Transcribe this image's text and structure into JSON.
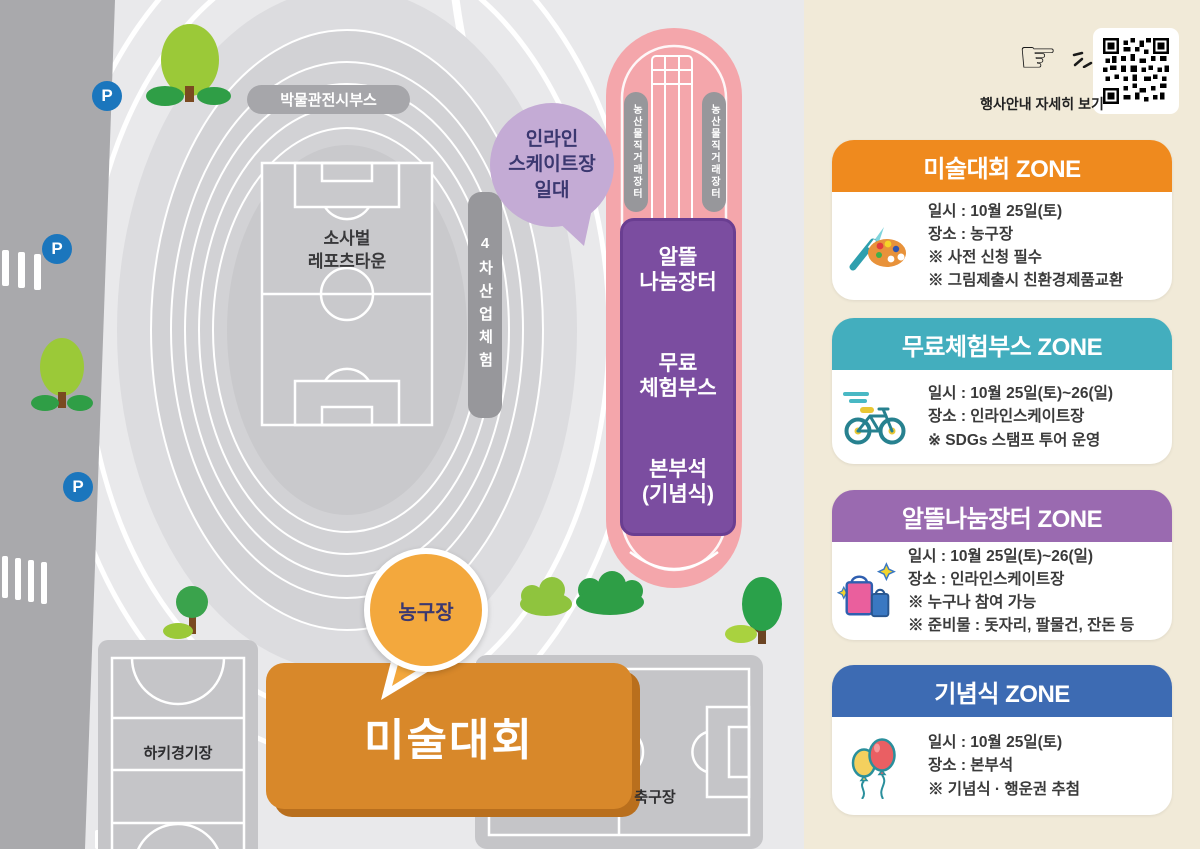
{
  "map": {
    "parking_label": "P",
    "museum_booth_label": "박물관전시부스",
    "stadium_label": "소사벌\n레포츠타운",
    "inline_skate_callout": "인라인\n스케이트장\n일대",
    "industry_experience_label": "4차산업체험",
    "produce_market_label": "농산물직거래장터",
    "flea_market_label": "알뜰\n나눔장터",
    "free_booth_label": "무료\n체험부스",
    "hq_label": "본부석\n(기념식)",
    "basketball_callout": "농구장",
    "art_contest_label": "미술대회",
    "hockey_label": "하키경기장",
    "soccer_label": "축구장"
  },
  "panel": {
    "hand_icon": "☞",
    "qr_caption": "행사안내 자세히 보기",
    "cards": [
      {
        "title": "미술대회 ZONE",
        "accent": "#ef8a1e",
        "icon": "palette",
        "lines": [
          "일시 : 10월 25일(토)",
          "장소 : 농구장",
          "※ 사전 신청 필수",
          "※ 그림제출시 친환경제품교환"
        ]
      },
      {
        "title": "무료체험부스 ZONE",
        "accent": "#43aebe",
        "icon": "bicycle",
        "lines": [
          "일시 : 10월 25일(토)~26(일)",
          "장소 : 인라인스케이트장",
          "※ SDGs 스탬프 투어 운영"
        ]
      },
      {
        "title": "알뜰나눔장터 ZONE",
        "accent": "#9a6ab0",
        "icon": "shopping-bags",
        "lines": [
          "일시 : 10월 25일(토)~26(일)",
          "장소 : 인라인스케이트장",
          "※ 누구나 참여 가능",
          "※ 준비물 : 돗자리, 팔물건, 잔돈 등"
        ]
      },
      {
        "title": "기념식 ZONE",
        "accent": "#3d6bb3",
        "icon": "balloons",
        "lines": [
          "일시 : 10월 25일(토)",
          "장소 : 본부석",
          "※ 기념식 · 행운권 추첨"
        ]
      }
    ]
  },
  "colors": {
    "panel_bg": "#f1ead8",
    "map_bg": "#e9e9eb",
    "road_gray": "#a9a9ac",
    "pink_zone": "#f4a6ab",
    "purple_zone": "#7b4da0",
    "orange_box": "#d8882a",
    "callout_orange": "#f3a83d",
    "callout_lavender": "#c4abd5",
    "parking_blue": "#1b76bd"
  }
}
